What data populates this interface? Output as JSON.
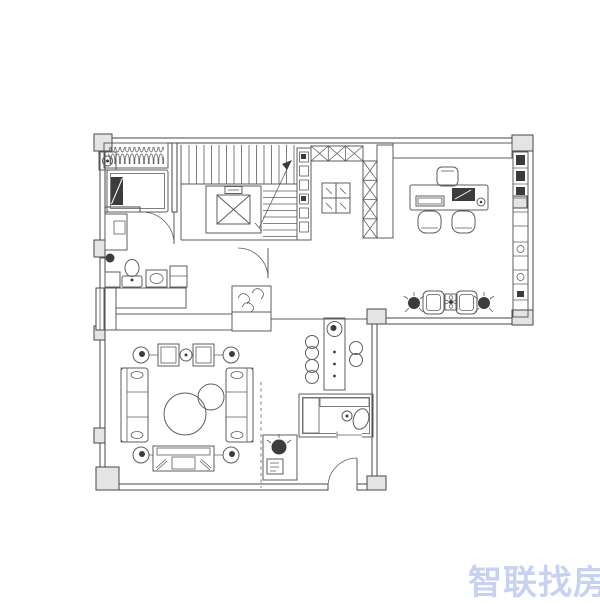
{
  "watermark": {
    "text": "智联找房"
  },
  "palette": {
    "wall": "#474747",
    "line": "#5e5e5e",
    "light": "#e4e4e4",
    "dark": "#3c3c3c",
    "watermark": "#c7d2f1",
    "background": "#ffffff"
  },
  "floorplan": {
    "type": "residential-floor-plan",
    "rooms": [
      {
        "id": "bedroom",
        "items": [
          "wardrobe-hanger-rail",
          "bedside-lamp-box",
          "bed",
          "pillow",
          "dresser",
          "floor-lamp-dot",
          "swing-door"
        ]
      },
      {
        "id": "stair-core",
        "items": [
          "stair-flight-up",
          "stair-flight-side",
          "direction-arrow",
          "elevator-shaft",
          "hall-shelf",
          "hall-door"
        ]
      },
      {
        "id": "study-office",
        "items": [
          "top-bookshelf",
          "side-bookshelf",
          "right-bookshelf",
          "truss-partition-top",
          "truss-partition-side",
          "display-cabinet",
          "desk",
          "keyboard",
          "laptop",
          "mug",
          "task-chair",
          "visitor-chair-1",
          "visitor-chair-2",
          "lounge-chair-1",
          "lounge-chair-2",
          "flower-table",
          "plant-1",
          "plant-2"
        ]
      },
      {
        "id": "powder-area",
        "items": [
          "toilet",
          "vanity",
          "low-cabinet",
          "tall-cabinet",
          "shoe-cabinet-upper",
          "shoe-cabinet-lower",
          "coat-cabinet",
          "window"
        ]
      },
      {
        "id": "living-room",
        "items": [
          "floor-lamp-1",
          "floor-lamp-2",
          "floor-lamp-3",
          "floor-lamp-4",
          "armchair-1",
          "armchair-2",
          "tea-table",
          "sofa-left",
          "sofa-right",
          "round-coffee-table-large",
          "round-coffee-table-small",
          "tv-bench"
        ]
      },
      {
        "id": "dining-area",
        "items": [
          "dining-table",
          "table-plant",
          "dining-chair-1",
          "dining-chair-2",
          "dining-chair-3"
        ]
      },
      {
        "id": "bathroom",
        "items": [
          "shower-hatch",
          "vanity-hatch-band",
          "faucet",
          "wash-basin",
          "sliding-door"
        ]
      },
      {
        "id": "entry",
        "items": [
          "entry-swing-door",
          "console-cabinet",
          "console-plant",
          "curtain-track-dashed"
        ]
      }
    ]
  }
}
